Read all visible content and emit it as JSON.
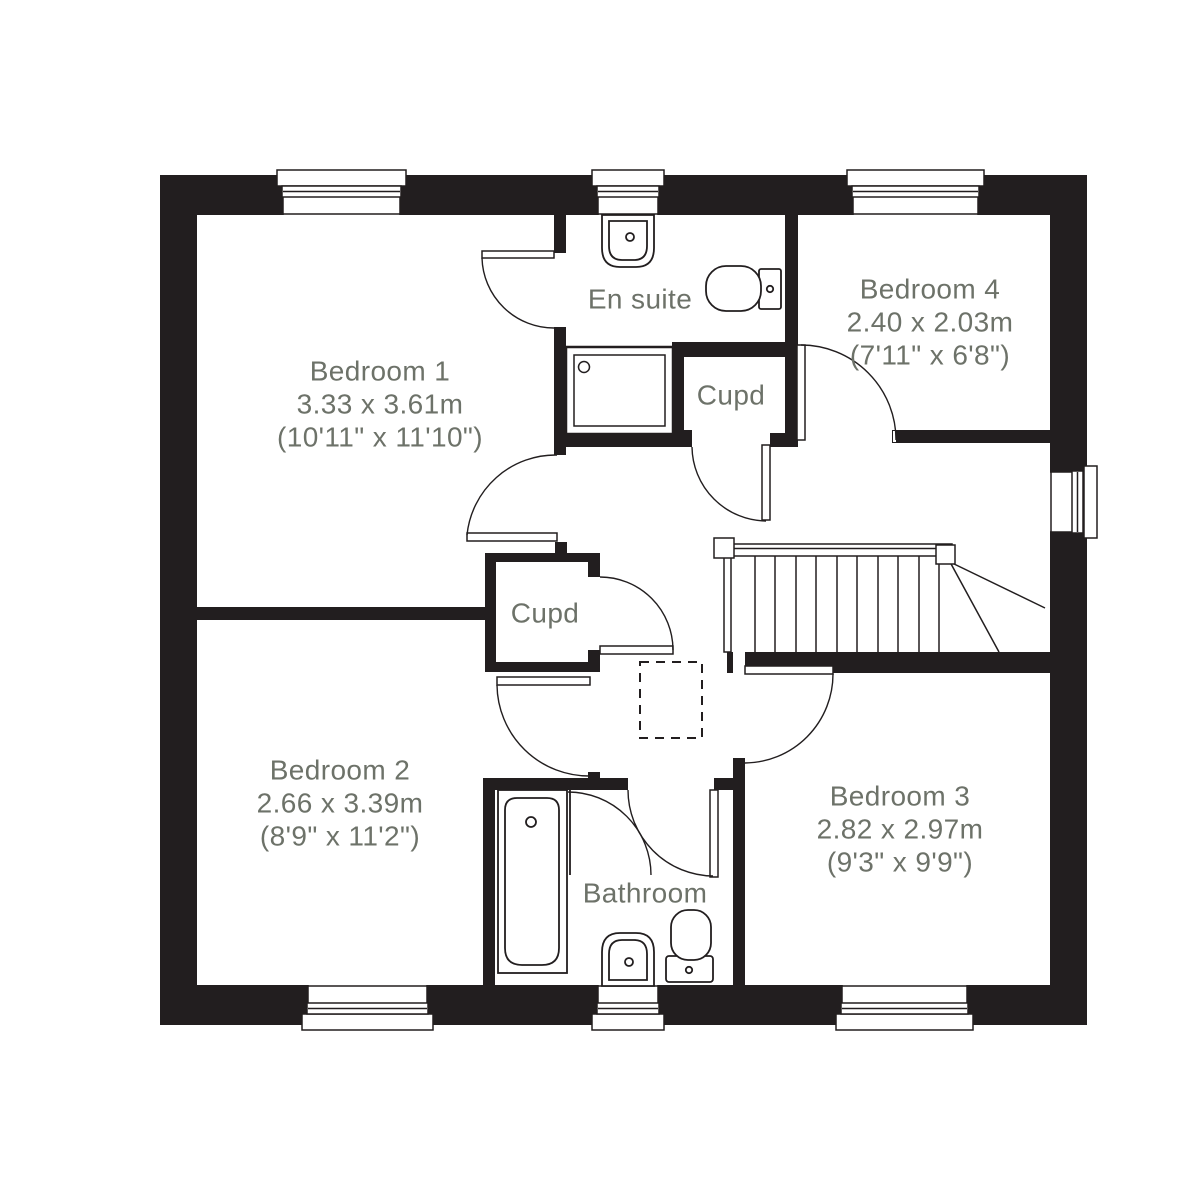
{
  "title": "First floor plan",
  "rooms": {
    "bedroom1": {
      "name": "Bedroom 1",
      "metric": "3.33 x 3.61m",
      "imperial": "(10'11\" x 11'10\")"
    },
    "bedroom2": {
      "name": "Bedroom 2",
      "metric": "2.66 x 3.39m",
      "imperial": "(8'9\" x 11'2\")"
    },
    "bedroom3": {
      "name": "Bedroom 3",
      "metric": "2.82 x 2.97m",
      "imperial": "(9'3\" x 9'9\")"
    },
    "bedroom4": {
      "name": "Bedroom 4",
      "metric": "2.40 x 2.03m",
      "imperial": "(7'11\" x 6'8\")"
    },
    "ensuite": {
      "name": "En suite"
    },
    "bathroom": {
      "name": "Bathroom"
    },
    "cupd_top": {
      "label": "Cupd"
    },
    "cupd_mid": {
      "label": "Cupd"
    }
  },
  "colors": {
    "wall": "#221e1f",
    "label_text": "#6d7269",
    "background": "#ffffff"
  },
  "fixtures": [
    "bath",
    "shower",
    "ensuite-basin",
    "ensuite-toilet",
    "bathroom-basin",
    "bathroom-toilet",
    "stairs",
    "loft-hatch"
  ]
}
